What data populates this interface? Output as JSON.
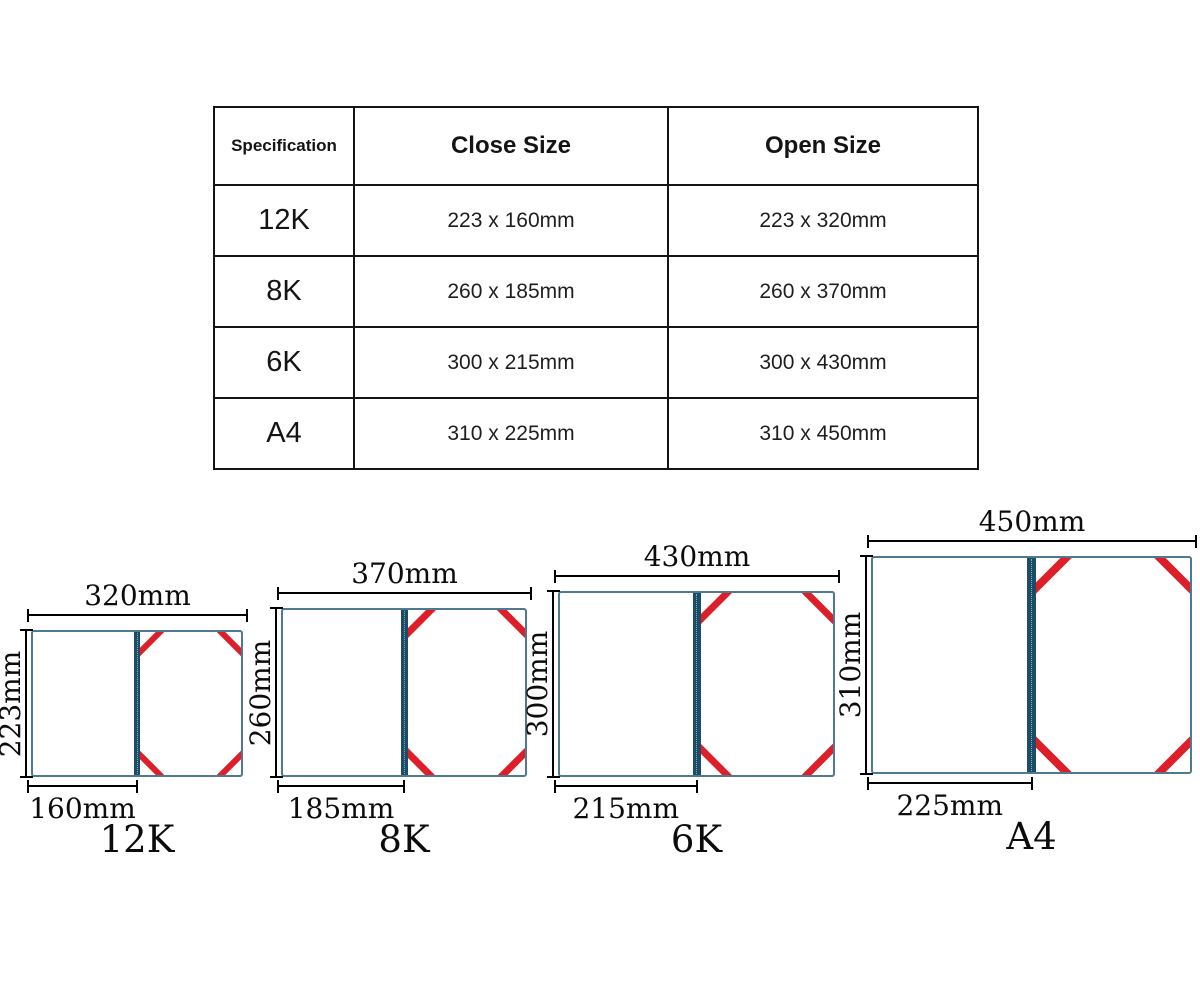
{
  "table": {
    "headers": [
      "Specification",
      "Close Size",
      "Open Size"
    ],
    "rows": [
      {
        "spec": "12K",
        "close": "223 x 160mm",
        "open": "223 x 320mm"
      },
      {
        "spec": "8K",
        "close": "260 x 185mm",
        "open": "260 x 370mm"
      },
      {
        "spec": "6K",
        "close": "300 x 215mm",
        "open": "300 x 430mm"
      },
      {
        "spec": "A4",
        "close": "310 x 225mm",
        "open": "310 x 450mm"
      }
    ]
  },
  "diagrams": [
    {
      "label": "12K",
      "open_width": "320mm",
      "height": "223mm",
      "close_width": "160mm"
    },
    {
      "label": "8K",
      "open_width": "370mm",
      "height": "260mm",
      "close_width": "185mm"
    },
    {
      "label": "6K",
      "open_width": "430mm",
      "height": "300mm",
      "close_width": "215mm"
    },
    {
      "label": "A4",
      "open_width": "450mm",
      "height": "310mm",
      "close_width": "225mm"
    }
  ],
  "colors": {
    "ribbon_red": "#dc1f28",
    "folder_border": "#4d7a91",
    "spine_navy": "#1c4c66"
  }
}
